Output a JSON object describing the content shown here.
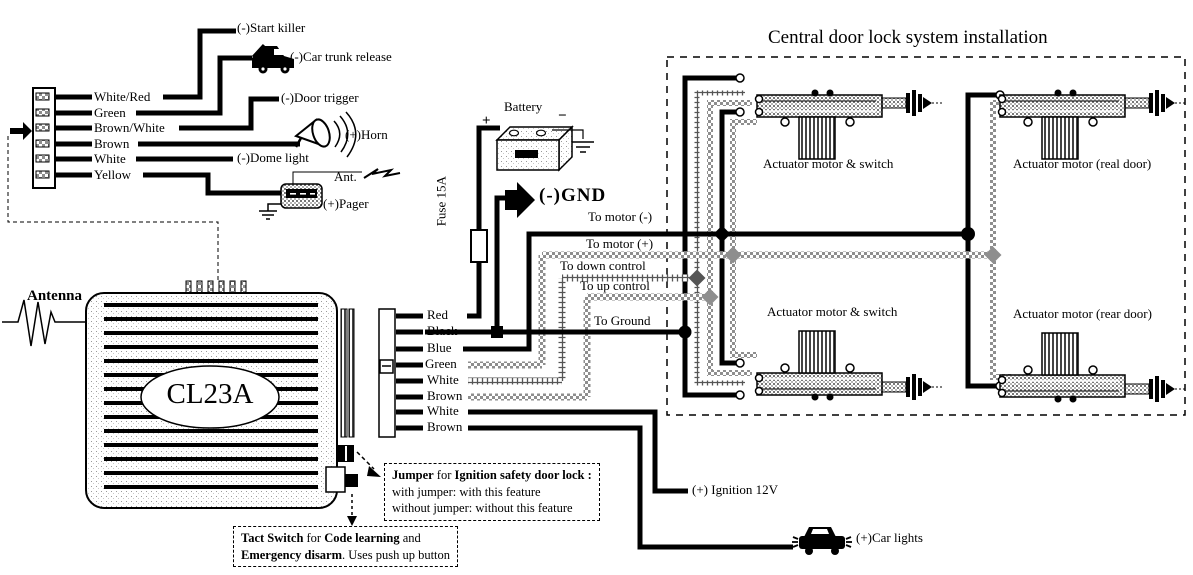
{
  "diagram": {
    "title": "Central door lock system installation",
    "unit_model": "CL23A",
    "antenna_label": "Antenna"
  },
  "left_connector": {
    "wires": [
      "White/Red",
      "Green",
      "Brown/White",
      "Brown",
      "White",
      "Yellow"
    ],
    "functions": {
      "start_killer": "(-)Start killer",
      "car_trunk_release": "(-)Car trunk release",
      "door_trigger": "(-)Door trigger",
      "horn": "(+)Horn",
      "dome_light": "(-)Dome light",
      "pager": "(+)Pager",
      "pager_antenna": "Ant."
    }
  },
  "power": {
    "battery_label": "Battery",
    "battery_plus": "+",
    "battery_minus": "−",
    "fuse_label": "Fuse 15A",
    "gnd_label": "(-)GND"
  },
  "main_connector": {
    "wires": [
      "Red",
      "Black",
      "Blue",
      "Green",
      "White",
      "Brown",
      "White",
      "Brown"
    ]
  },
  "signals": {
    "to_motor_minus": "To motor (-)",
    "to_motor_plus": "To motor (+)",
    "to_down_control": "To down control",
    "to_up_control": "To up control",
    "to_ground": "To Ground",
    "ignition": "(+) Ignition 12V",
    "car_lights": "(+)Car lights"
  },
  "actuators": {
    "labels": [
      "Actuator motor & switch",
      "Actuator motor (real door)",
      "Actuator motor & switch",
      "Actuator motor (rear door)"
    ]
  },
  "notes": {
    "jumper": {
      "b1": "Jumper",
      "t1": " for ",
      "b2": "Ignition safety door lock :",
      "l2": "with jumper: with this feature",
      "l3": "without jumper: without this feature"
    },
    "tact": {
      "b1": "Tact Switch",
      "t1": " for ",
      "b2": "Code learning",
      "t2": " and",
      "b3": "Emergency disarm",
      "t3": ". Uses push up button"
    }
  }
}
